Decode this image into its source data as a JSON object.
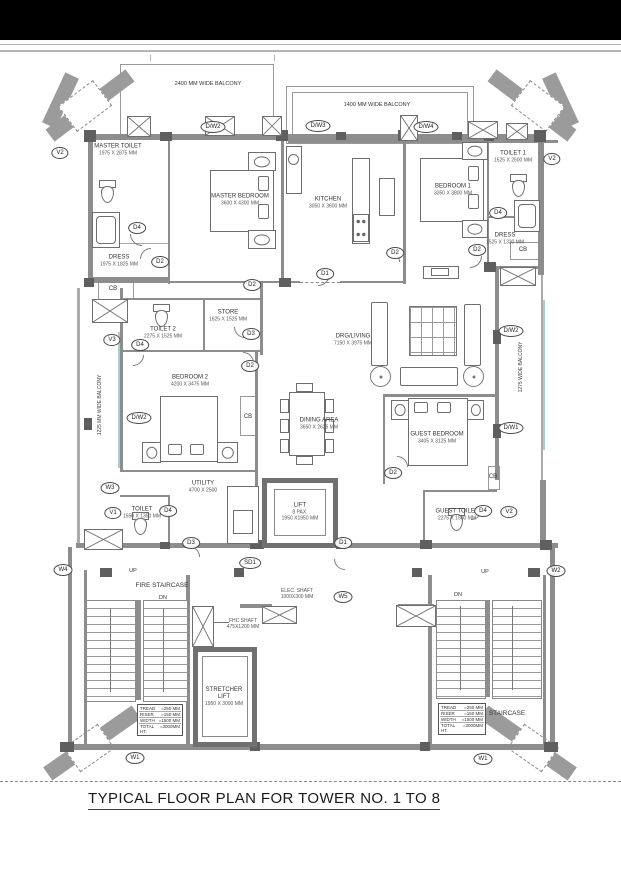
{
  "title": "TYPICAL FLOOR PLAN FOR TOWER NO. 1 TO 8",
  "balconies": [
    {
      "label": "2400 MM WIDE BALCONY"
    },
    {
      "label": "1400 MM WIDE BALCONY"
    },
    {
      "label": "1225 MM WIDE BALCONY"
    },
    {
      "label": "1275 WIDE BALCONY"
    }
  ],
  "rooms": [
    {
      "name": "MASTER TOILET",
      "dims": "1975 X 2875 MM"
    },
    {
      "name": "MASTER BEDROOM",
      "dims": "3600 X 4300 MM"
    },
    {
      "name": "KITCHEN",
      "dims": "3050 X 3600 MM"
    },
    {
      "name": "BEDROOM 1",
      "dims": "3350 X 3800 MM"
    },
    {
      "name": "TOILET 1",
      "dims": "1525 X 2500 MM"
    },
    {
      "name": "DRESS",
      "dims": "1975 X 1825 MM"
    },
    {
      "name": "DRESS",
      "dims": "1525 X 1330 MM"
    },
    {
      "name": "STORE",
      "dims": "1625 X 1525 MM"
    },
    {
      "name": "TOILET 2",
      "dims": "2275 X 1525 MM"
    },
    {
      "name": "DRG/LIVING",
      "dims": "7150 X 3975 MM"
    },
    {
      "name": "BEDROOM 2",
      "dims": "4200 X 3475 MM"
    },
    {
      "name": "DINING AREA",
      "dims": "3650 X 2625 MM"
    },
    {
      "name": "GUEST BEDROOM",
      "dims": "3405 X 3125 MM"
    },
    {
      "name": "UTILITY",
      "dims": "4700 X 2500"
    },
    {
      "name": "TOILET",
      "dims": "1550 X 1350 MM"
    },
    {
      "name": "GUEST TOILET",
      "dims": "2275 X 1500 MM"
    }
  ],
  "lift": {
    "name": "LIFT",
    "capacity": "8 PAX.",
    "dims": "1950 X1950 MM"
  },
  "stretcher_lift": {
    "name": "STRETCHER",
    "name2": "LIFT",
    "dims": "1950 X 3000 MM"
  },
  "shafts": [
    {
      "name": "ELEC. SHAFT",
      "dims": "1000X300 MM"
    },
    {
      "name": "FHC SHAFT",
      "dims": "475X1200 MM"
    }
  ],
  "stairs": {
    "fire_staircase_label": "FIRE STAIRCASE",
    "staircase_label": "STAIRCASE",
    "up": "UP",
    "dn": "DN",
    "table_rows": [
      {
        "item": "TREAD",
        "value": "=250 MM"
      },
      {
        "item": "RISER",
        "value": "=150 MM"
      },
      {
        "item": "WIDTH",
        "value": "=1500 MM"
      },
      {
        "item": "TOTAL HT.",
        "value": "=3000MM"
      }
    ]
  },
  "cb_label": "CB",
  "markers": [
    {
      "label": "V2"
    },
    {
      "label": "D/W2"
    },
    {
      "label": "D/W3"
    },
    {
      "label": "D/W4"
    },
    {
      "label": "V2"
    },
    {
      "label": "D4"
    },
    {
      "label": "D2"
    },
    {
      "label": "D1"
    },
    {
      "label": "D2"
    },
    {
      "label": "D2"
    },
    {
      "label": "D4"
    },
    {
      "label": "D2"
    },
    {
      "label": "D3"
    },
    {
      "label": "D2"
    },
    {
      "label": "V3"
    },
    {
      "label": "D4"
    },
    {
      "label": "D/W2"
    },
    {
      "label": "D/W2"
    },
    {
      "label": "D/W1"
    },
    {
      "label": "D2"
    },
    {
      "label": "W3"
    },
    {
      "label": "V1"
    },
    {
      "label": "D4"
    },
    {
      "label": "D3"
    },
    {
      "label": "D1"
    },
    {
      "label": "SD1"
    },
    {
      "label": "D4"
    },
    {
      "label": "V2"
    },
    {
      "label": "W4"
    },
    {
      "label": "W2"
    },
    {
      "label": "W5"
    },
    {
      "label": "W1"
    },
    {
      "label": "W1"
    }
  ],
  "colors": {
    "top_band": "#000000",
    "wall": "#8d8d8d",
    "wall_dark": "#5f5f5f",
    "accent_teal": "#a8cfcf",
    "line": "#777777"
  }
}
